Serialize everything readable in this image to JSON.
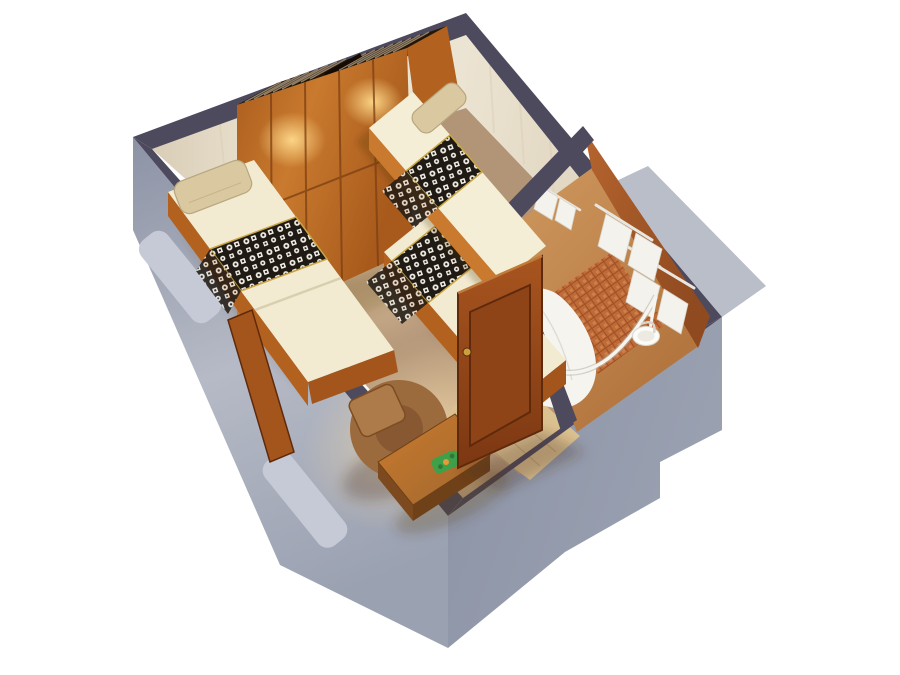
{
  "scene": {
    "type": "3d-cutaway-floor-plan-render",
    "view": "isometric-birds-eye",
    "background": "white",
    "rooms": [
      {
        "name": "cabin",
        "floor": "tan-carpet",
        "furniture": [
          "wardrobe-with-open-hanger-compartments-and-spotlights",
          "single-bed-with-patterned-runner-and-pillow",
          "upper-berth-with-patterned-runner-and-pillow",
          "lower-bed-with-patterned-runner",
          "armchair-with-back-cushion",
          "coffee-table-with-green-plant",
          "open-wooden-entry-door",
          "wood-side-column"
        ]
      },
      {
        "name": "bathroom",
        "floor": "terracotta-mosaic",
        "fixtures": [
          "towel-racks-with-white-towels",
          "hand-towels",
          "curved-shower-curtain-rail",
          "white-shower-curtain",
          "round-washbasin-with-faucet",
          "entry-wood-floor-strip"
        ]
      }
    ],
    "exterior": {
      "walls": "blue-gray-shell",
      "details": [
        "window-ledge-upper-left",
        "window-ledge-lower-left",
        "stepped-notch-right-wall"
      ]
    }
  },
  "colors": {
    "background": "#ffffff",
    "trim": "#4e4a5e",
    "wall_cream": "#ece4d2",
    "wall_cream_dark": "#d9cdb6",
    "exterior_gray": "#9aa1b1",
    "exterior_gray_light": "#b6bac6",
    "exterior_gray_dark": "#8c93a5",
    "window_ledge": "#c6cad6",
    "carpet": "#b29477",
    "carpet_light": "#ecd3a6",
    "carpet_dark": "#9c8163",
    "wood_base": "#b2611f",
    "wood_dark": "#a3551b",
    "wood_light": "#c97a2e",
    "wardrobe_top": "#241608",
    "wardrobe_lit": "#ffd98a",
    "wardrobe_base": "#a85a1c",
    "wardrobe_line": "#7c3f12",
    "hanger": "#9c8c74",
    "divider_dark": "#140c04",
    "mattress": "#f2ebd1",
    "mattress_bright": "#f5eed6",
    "mattress_shadow": "#d8cfae",
    "pillow": "#d9c8a0",
    "pillow_edge": "#b7a67e",
    "runner_dark": "#201a14",
    "runner_light": "#f2efe6",
    "runner_trim": "#c9a544",
    "chair_body": "#9b6a3d",
    "chair_seat": "#875832",
    "chair_cushion": "#ad7a4a",
    "chair_edge": "#7c4c22",
    "table_top": "#a0672f",
    "table_side": "#6f4118",
    "table_side2": "#7c4a1e",
    "plant_green": "#3fa04a",
    "plant_green_dark": "#2c7a36",
    "plant_accent": "#e89a38",
    "door_wood": "#a8551f",
    "door_wood_dark": "#7c3712",
    "door_inset": "#8f4417",
    "door_edge": "#5f2a0c",
    "door_highlight": "#c07a3a",
    "door_handle": "#caa23c",
    "bath_wall": "#b5642e",
    "bath_wall_dark": "#8f4a20",
    "bath_floor": "#cf9a60",
    "bath_floor_dark": "#b0703a",
    "mosaic": "#bd6b38",
    "mosaic_dark": "#a04e24",
    "mosaic_light": "#d58a50",
    "towel": "#f4f2ec",
    "towel_shadow": "#d8d5cc",
    "chrome": "#e8e6e0",
    "chrome_shadow": "#b9b6ac",
    "curtain": "#f5f4ef",
    "curtain_shadow": "#d9d7cf",
    "sink": "#fbfbf8",
    "sink_inner": "#eceae2",
    "entry_wood": "#dcc190",
    "entry_wood_line": "#c5a877",
    "shadow": "#4a2f14"
  }
}
